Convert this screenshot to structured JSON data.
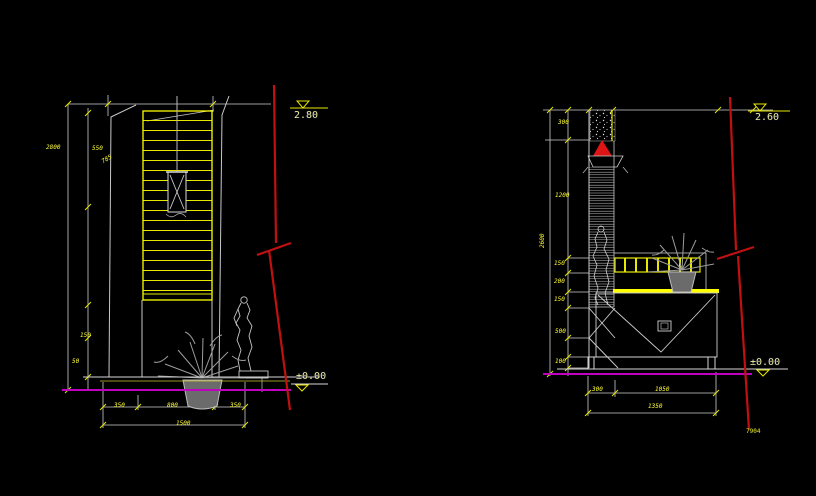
{
  "app": {
    "background": "#000000",
    "description": "CAD elevation drawings, two interior partition/cabinet views"
  },
  "colors": {
    "line_white": "#d4d4d4",
    "accent_yellow": "#ffff00",
    "level_red": "#c01010",
    "floor_magenta": "#c000c0",
    "entity_gray": "#9a9a9a"
  },
  "left_view": {
    "level_top_label": "2.80",
    "level_floor_label": "±0.00",
    "dim_total_height": "2800",
    "dim_seg_a": "550",
    "dim_seg_b": "785",
    "dim_seg_c": "150",
    "dim_seg_d": "50",
    "dim_bottom": [
      "350",
      "800",
      "350"
    ],
    "dim_bottom_total": "1500"
  },
  "right_view": {
    "level_top_label": "2.60",
    "level_floor_label": "±0.00",
    "dim_total_height": "2600",
    "dim_segs": [
      "300",
      "1200",
      "150",
      "200",
      "150",
      "500",
      "100"
    ],
    "dim_bottom": [
      "300",
      "1050"
    ],
    "dim_bottom_total": "1350"
  },
  "sheet": {
    "number": "7904"
  }
}
